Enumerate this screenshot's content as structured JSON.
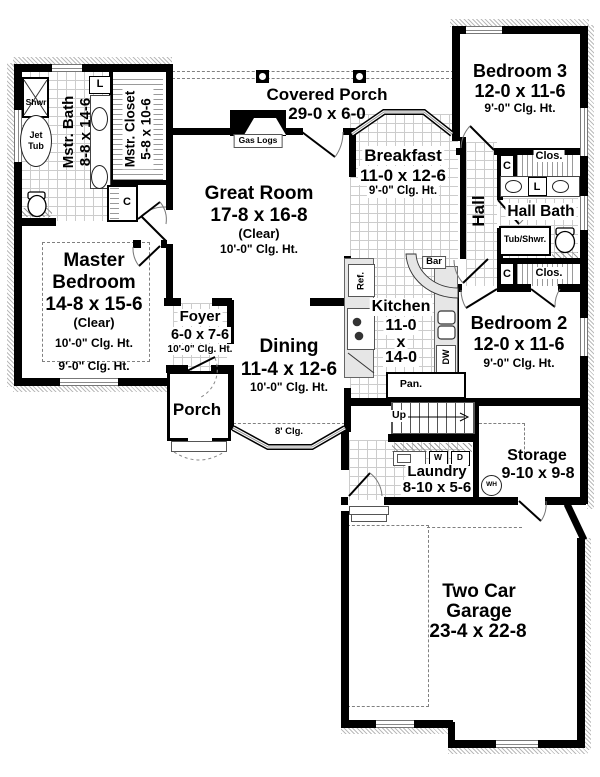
{
  "rooms": {
    "covered_porch": {
      "name": "Covered Porch",
      "dims": "29-0 x 6-0"
    },
    "bedroom3": {
      "name": "Bedroom 3",
      "dims": "12-0 x 11-6",
      "ceiling": "9'-0\" Clg. Ht."
    },
    "breakfast": {
      "name": "Breakfast",
      "dims": "11-0 x 12-6",
      "ceiling": "9'-0\" Clg. Ht."
    },
    "great_room": {
      "name": "Great Room",
      "dims": "17-8 x 16-8",
      "note": "(Clear)",
      "ceiling": "10'-0\" Clg. Ht."
    },
    "mstr_bath": {
      "name": "Mstr. Bath",
      "dims": "8-8 x 14-6"
    },
    "mstr_closet": {
      "name": "Mstr. Closet",
      "dims": "5-8 x 10-6"
    },
    "hall": {
      "name": "Hall"
    },
    "hall_bath": {
      "name": "Hall Bath"
    },
    "master_bedroom": {
      "name1": "Master",
      "name2": "Bedroom",
      "dims": "14-8 x 15-6",
      "note": "(Clear)",
      "ceiling": "10'-0\" Clg. Ht.",
      "ceiling2": "9'-0\" Clg. Ht."
    },
    "foyer": {
      "name": "Foyer",
      "dims": "6-0 x 7-6",
      "ceiling": "10'-0\" Clg. Ht."
    },
    "dining": {
      "name": "Dining",
      "dims": "11-4 x 12-6",
      "ceiling": "10'-0\" Clg. Ht.",
      "bay_ceiling": "8' Clg."
    },
    "kitchen": {
      "name": "Kitchen",
      "dim_w": "11-0",
      "dim_by": "x",
      "dim_l": "14-0"
    },
    "bedroom2": {
      "name": "Bedroom 2",
      "dims": "12-0 x 11-6",
      "ceiling": "9'-0\" Clg. Ht."
    },
    "porch": {
      "name": "Porch"
    },
    "laundry": {
      "name": "Laundry",
      "dims": "8-10 x 5-6"
    },
    "storage": {
      "name": "Storage",
      "dims": "9-10 x 9-8"
    },
    "garage": {
      "name1": "Two Car",
      "name2": "Garage",
      "dims": "23-4 x 22-8"
    }
  },
  "fixtures": {
    "gas_logs": "Gas Logs",
    "shower": "Shwr",
    "jet1": "Jet",
    "jet2": "Tub",
    "linen": "L",
    "closet": "C",
    "closet_full": "Clos.",
    "tub_shower": "Tub/Shwr.",
    "bar": "Bar",
    "fridge": "Ref.",
    "dishwasher": "DW",
    "pantry": "Pan.",
    "stairs_up": "Up",
    "washer": "W",
    "dryer": "D",
    "water_heater": "WH"
  },
  "colors": {
    "wall": "#000000",
    "tile_line": "#cccccc",
    "hatch": "#9a9a9a",
    "dash": "#808080",
    "counter": "#e6e6e6"
  }
}
